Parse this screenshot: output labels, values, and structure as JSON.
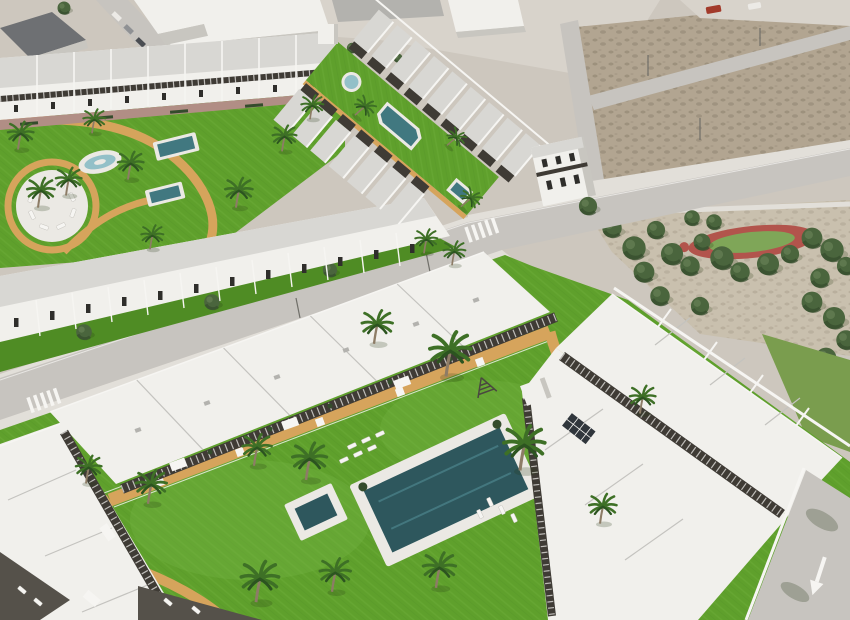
{
  "scene": {
    "title": "Aerial 3D render of a new residential development",
    "description": "Bird's-eye architectural visualization of a white Mediterranean townhouse and apartment development: communal lawns with turquoise swimming pools, sun loungers, palm trees and sandy paths; rows of flat- and pitched-roof white buildings with dark pergolas; an existing town street with parked cars at the top left; empty dirt building plots with roads at the top right; a public park with pine trees and a circular red playground track at the middle right; asphalt streets with zebra crossings and a white turn arrow on the bottom-right road."
  },
  "regions": {
    "old_town": "existing town blocks with parked cars",
    "vacant_lots": "undeveloped dirt plots with access roads and a red car",
    "park": "tree-filled park with circular red play track",
    "phase1": "townhouse complex with garden pools",
    "linear_garden": "long lawn strip with lap pool between townhouse rows",
    "phase2": "apartment complex around large communal pool",
    "street_east": "road with white direction arrow"
  },
  "inventory": {
    "phase1_pools": 4,
    "linear_garden_pools": 3,
    "phase2_pools": 2,
    "playground": "red oval track with green infield",
    "crosswalks": 2,
    "red_car": 1,
    "sun_lounger_clusters": 3
  },
  "colors": {
    "base": "#cdc7be",
    "pavement": "#d8d3cb",
    "road": "#c7c4bf",
    "sidewalk": "#e2dfd9",
    "dirt": "#b2a591",
    "dirt_dark": "#887d6a",
    "park_ground": "#c9c0ae",
    "grass": "#5fa02c",
    "grass_light": "#76b544",
    "grass_dark": "#4f8c24",
    "grass_dull": "#7a9d4e",
    "sand_path": "#d6a45c",
    "deck": "#ebe9e4",
    "pool_deep": "#2e575d",
    "pool_mid": "#417880",
    "pool_light": "#93c0c8",
    "bldg": "#f1f0ec",
    "bldg_shadow": "#c8c6c0",
    "roof": "#d8d7d3",
    "roof_dark": "#b3b2ae",
    "roof_line": "#c4c3bf",
    "pergola": "#3f3b35",
    "win": "#2f2e2b",
    "wall": "#f6f5f2",
    "paving": "#b18e85",
    "tree": "#4a653d",
    "tree_dark": "#344c2c",
    "palm": "#3e7026",
    "palm_dark": "#2c5420",
    "trunk": "#8d7c66",
    "old_roof": "#6e7073",
    "old_roof2": "#7c7e81",
    "red_ring": "#b2544c",
    "play_green": "#7fa658",
    "car_red": "#a23a2a",
    "car_white": "#eceae6",
    "car_gray": "#8f9194",
    "car_dark": "#4a4d52",
    "pole": "#6f6e68",
    "terrace": "#55514a",
    "panel": "#30363c",
    "frame": "#4a4740",
    "shade": "#243512"
  }
}
